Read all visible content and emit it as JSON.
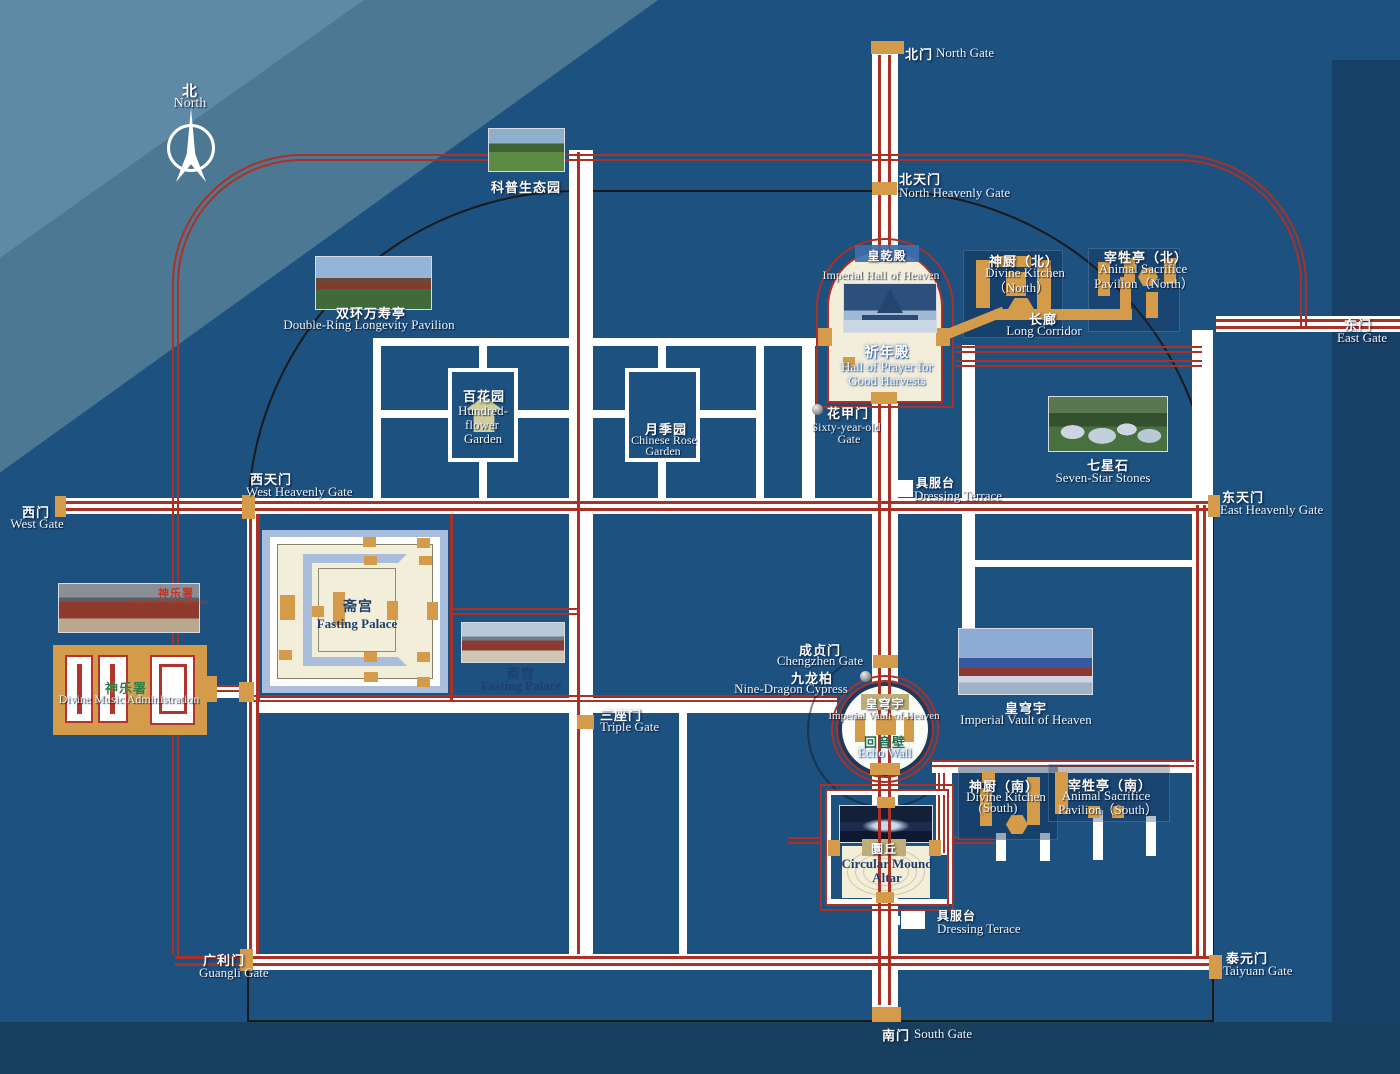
{
  "labels": {
    "compass": {
      "zh": "北",
      "en": "North"
    },
    "north_gate": {
      "zh": "北门",
      "en": "North Gate"
    },
    "eco_garden": {
      "zh": "科普生态园"
    },
    "north_heavenly_gate": {
      "zh": "北天门",
      "en": "North Heavenly Gate"
    },
    "double_ring": {
      "zh": "双环万寿亭",
      "en": "Double-Ring Longevity Pavilion"
    },
    "imperial_hall": {
      "zh": "皇乾殿",
      "en": "Imperial Hall of Heaven"
    },
    "hall_of_prayer": {
      "zh": "祈年殿",
      "en1": "Hall of Prayer for",
      "en2": "Good Harvests"
    },
    "divine_kitchen_north": {
      "zh": "神厨（北）",
      "en1": "Divine Kitchen",
      "en2": "（North）"
    },
    "animal_sacrifice_north": {
      "zh": "宰牲亭（北）",
      "en1": "Animal Sacrifice",
      "en2": "Pavilion（North）"
    },
    "long_corridor": {
      "zh": "长廊",
      "en": "Long Corridor"
    },
    "east_gate": {
      "zh": "东门",
      "en": "East Gate"
    },
    "hundred_flower_garden": {
      "zh": "百花园",
      "en1": "Hundred-",
      "en2": "flower",
      "en3": "Garden"
    },
    "chinese_rose_garden": {
      "zh": "月季园",
      "en1": "Chinese Rose",
      "en2": "Garden"
    },
    "sixty_year_old_gate": {
      "zh": "花甲门",
      "en1": "Sixty-year-old",
      "en2": "Gate"
    },
    "dressing_terrace_north": {
      "zh": "具服台",
      "en": "Dressing Terrace"
    },
    "seven_star_stones": {
      "zh": "七星石",
      "en": "Seven-Star Stones"
    },
    "west_heavenly_gate": {
      "zh": "西天门",
      "en": "West Heavenly Gate"
    },
    "west_gate": {
      "zh": "西门",
      "en": "West Gate"
    },
    "east_heavenly_gate": {
      "zh": "东天门",
      "en": "East Heavenly Gate"
    },
    "fasting_palace": {
      "zh": "斋宫",
      "en": "Fasting Palace"
    },
    "fasting_palace_photo": {
      "zh": "斋宫",
      "en": "Fasting Palace"
    },
    "divine_music": {
      "zh": "神乐署",
      "en": "Divine Music Administration"
    },
    "divine_music_photo": {
      "zh": "神乐署",
      "en": "Divine Music Administration"
    },
    "chengzhen_gate": {
      "zh": "成贞门",
      "en": "Chengzhen Gate"
    },
    "nine_dragon_cypress": {
      "zh": "九龙柏",
      "en": "Nine-Dragon Cypress"
    },
    "imperial_vault": {
      "zh": "皇穹宇",
      "en": "Imperial Vault of Heaven"
    },
    "echo_wall": {
      "zh": "回音壁",
      "en": "Echo Wall"
    },
    "triple_gate": {
      "zh": "三座门",
      "en": "Triple Gate"
    },
    "imperial_vault_photo": {
      "zh": "皇穹宇",
      "en": "Imperial Vault of Heaven"
    },
    "divine_kitchen_south": {
      "zh": "神厨（南）",
      "en1": "Divine Kitchen",
      "en2": "(South)"
    },
    "animal_sacrifice_south": {
      "zh": "宰牲亭（南）",
      "en1": "Animal Sacrifice",
      "en2": "Pavilion（South）"
    },
    "circular_mound": {
      "zh": "圜丘",
      "en1": "Circular Mound",
      "en2": "Altar"
    },
    "dressing_terrace_south": {
      "zh": "具服台",
      "en": "Dressing Terace"
    },
    "guangli_gate": {
      "zh": "广利门",
      "en": "Guangli Gate"
    },
    "taiyuan_gate": {
      "zh": "泰元门",
      "en": "Taiyuan Gate"
    },
    "south_gate": {
      "zh": "南门",
      "en": "South Gate"
    }
  },
  "colors": {
    "park_blue": "#1d5180",
    "route_red": "#ab3126",
    "road_white": "#ffffff",
    "gate_orange": "#d49c4a",
    "ivory": "#f3eeda",
    "moat_blue": "#a9bddd",
    "navy_text": "#1e3f6d",
    "label_tan": "#bfae77",
    "label_blue": "#3f6fae",
    "green_text": "#2f7d44"
  }
}
